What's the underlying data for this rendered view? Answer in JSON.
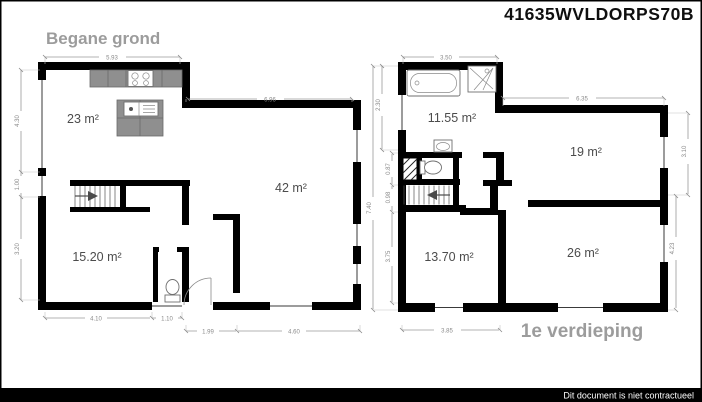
{
  "header": {
    "code": "41635WVLDORPS70B"
  },
  "footer": {
    "disclaimer": "Dit document is niet contractueel"
  },
  "ground_floor": {
    "title": "Begane grond",
    "rooms": {
      "kitchen": "23 m²",
      "living": "42 m²",
      "front_room": "15.20 m²"
    },
    "dims": {
      "top_kitchen": "5.93",
      "top_living": "6.96",
      "left_upper": "4.30",
      "left_door": "1.00",
      "left_lower": "3.20",
      "bottom_left": "4.10",
      "bottom_window": "1.10",
      "bottom_door": "1.99",
      "bottom_right": "4.60"
    }
  },
  "first_floor": {
    "title": "1e verdieping",
    "rooms": {
      "bathroom": "11.55 m²",
      "bedroom_right": "19 m²",
      "bedroom_back": "26 m²",
      "bedroom_front": "13.70 m²"
    },
    "dims": {
      "top_bathroom": "3.50",
      "top_bedroom": "6.35",
      "left_bathroom": "2.30",
      "left_total": "7.40",
      "left_wc": "0.87",
      "left_stairs": "0.98",
      "left_front": "3.75",
      "bottom_front": "3.85",
      "right_upper": "3.10",
      "right_lower": "4.23"
    }
  }
}
